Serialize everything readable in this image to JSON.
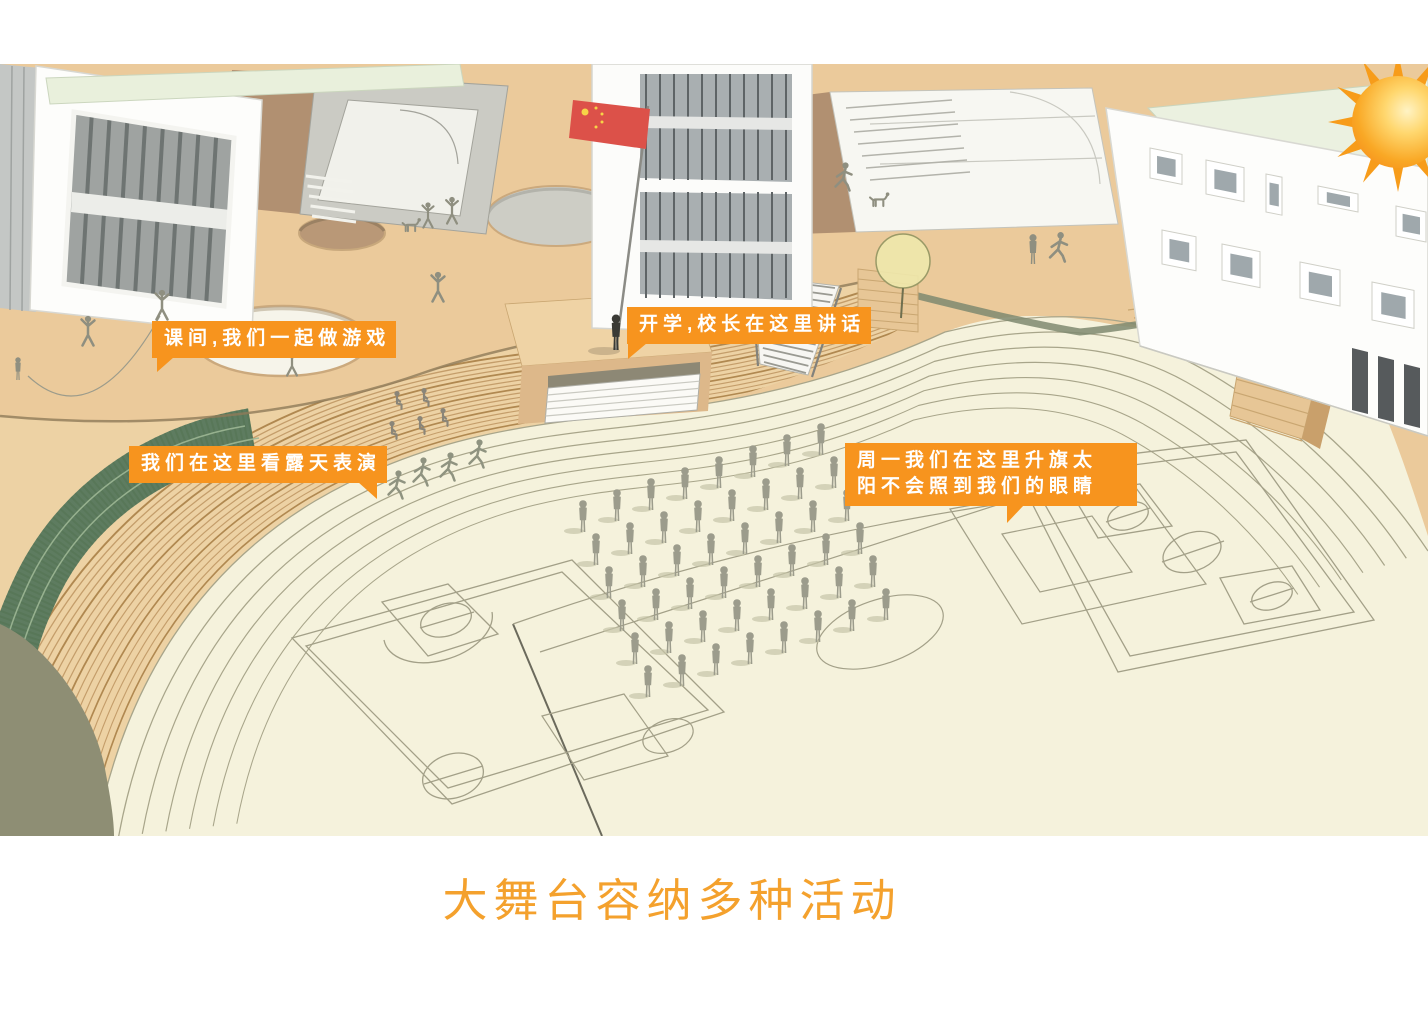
{
  "caption": {
    "text": "大舞台容纳多种活动"
  },
  "callouts": {
    "play_games": "课间,我们一起做游戏",
    "open_air_show": "我们在这里看露天表演",
    "principal_speech": "开学,校长在这里讲话",
    "flag_raising_line1": "周一我们在这里升旗太",
    "flag_raising_line2": "阳不会照到我们的眼睛"
  },
  "scene": {
    "formation": {
      "rows": 6,
      "cols": 8
    },
    "icons": [
      "sun-icon",
      "flag-icon",
      "tree-icon"
    ]
  },
  "colors": {
    "callout_orange": "#F7941E",
    "caption_orange": "#F4A12D",
    "plaza_tan": "#EBCA9B",
    "steps_tan": "#EDD2A4",
    "field_cream": "#F5F2DC",
    "green_bank": "#5E7C60",
    "olive_lawn": "#8E8E74",
    "flag_red": "#DC5149",
    "figure_gray": "#9C9C8C"
  }
}
